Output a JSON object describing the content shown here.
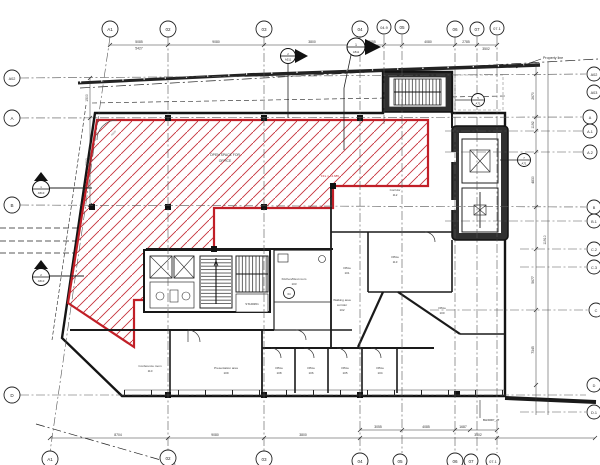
{
  "sheet": {
    "type": "architectural floor plan"
  },
  "grid": {
    "top": [
      "A1",
      "02",
      "03",
      "04",
      "04.9",
      "05",
      "06",
      "07",
      "07.1"
    ],
    "bottom": [
      "A1",
      "02",
      "03",
      "04",
      "05",
      "06",
      "07",
      "07.1"
    ],
    "left": [
      "A02",
      "A",
      "B",
      "D"
    ],
    "right": [
      "A02",
      "A03",
      "A",
      "A.1",
      "A.2",
      "B",
      "B.1",
      "C.2",
      "C.3",
      "C",
      "D",
      "D.1"
    ]
  },
  "rooms": {
    "open_space": {
      "line1": "OPEN SPACE FOR",
      "line2": "OFFICE"
    },
    "ffl": "FFL = +4.685",
    "corridor": {
      "name": "Corridor",
      "number": "112"
    },
    "office113": {
      "name": "Office",
      "number": "113"
    },
    "office101": {
      "name": "Office",
      "number": "101"
    },
    "kitchen": {
      "name": "Kitchen/Rest room",
      "number": "103"
    },
    "walking": {
      "line1": "Walking area",
      "line2": "corridor",
      "number": "102"
    },
    "office100": {
      "name": "Office",
      "number": "100"
    },
    "conference": {
      "name": "Conference room",
      "number": "110"
    },
    "presentation": {
      "name": "Presentation area",
      "number": "109"
    },
    "office108": {
      "name": "Office",
      "number": "108"
    },
    "office106": {
      "name": "Office",
      "number": "106"
    },
    "office105": {
      "name": "Office",
      "number": "105"
    },
    "office104": {
      "name": "Office",
      "number": "104"
    },
    "stair": {
      "label": "STAIR#01"
    }
  },
  "annotations": {
    "property_line": "Property line",
    "bh_note": "BH/DRP_JT",
    "radius": "R500"
  },
  "dimensions": {
    "top": [
      "5085",
      "5427",
      "9080",
      "3800",
      "3055",
      "4080",
      "2785",
      "3502"
    ],
    "bottom": [
      "8704",
      "9080",
      "3800",
      "3055",
      "4085",
      "1687",
      "3502"
    ],
    "right": [
      "2670",
      "1192",
      "4830",
      "5677",
      "7345",
      "11910"
    ],
    "left": [
      "1500",
      "8300"
    ]
  },
  "markers": {
    "m1": {
      "num": "1",
      "sheet": "A511"
    },
    "m2": {
      "num": "2",
      "sheet": "A511"
    },
    "m3": {
      "num": "1",
      "sheet": "A510"
    },
    "m4": {
      "num": "2",
      "sheet": "A510"
    },
    "m5": {
      "num": "7",
      "sheet": "A71"
    },
    "m6": {
      "num": "5",
      "sheet": "A71"
    },
    "door_tag": "04"
  },
  "colors": {
    "hatch_red": "#c5303a",
    "border_red": "#c11f27",
    "line_dark": "#1a1a1a"
  }
}
